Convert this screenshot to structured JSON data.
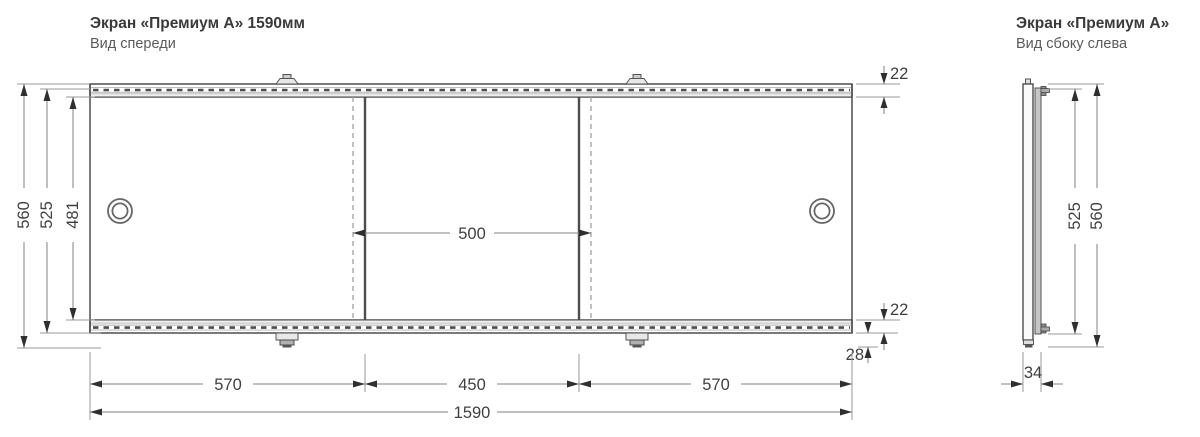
{
  "front_view": {
    "title": "Экран «Премиум А» 1590мм",
    "subtitle": "Вид спереди",
    "dimensions": {
      "total_height": "560",
      "frame_height": "525",
      "panel_height": "481",
      "top_rail_height": "22",
      "bottom_rail_height": "22",
      "leg_height": "28",
      "middle_panel_width": "500",
      "left_section_width": "570",
      "middle_section_width": "450",
      "right_section_width": "570",
      "total_width": "1590"
    }
  },
  "side_view": {
    "title": "Экран «Премиум А»",
    "subtitle": "Вид сбоку слева",
    "dimensions": {
      "frame_height": "525",
      "total_height": "560",
      "depth": "34"
    }
  },
  "colors": {
    "drawing_line": "#4d4d4d",
    "dimension_line": "#808080",
    "text": "#3f3f3f",
    "metal_fill": "#c6c6c6",
    "panel_fill": "#ffffff"
  }
}
